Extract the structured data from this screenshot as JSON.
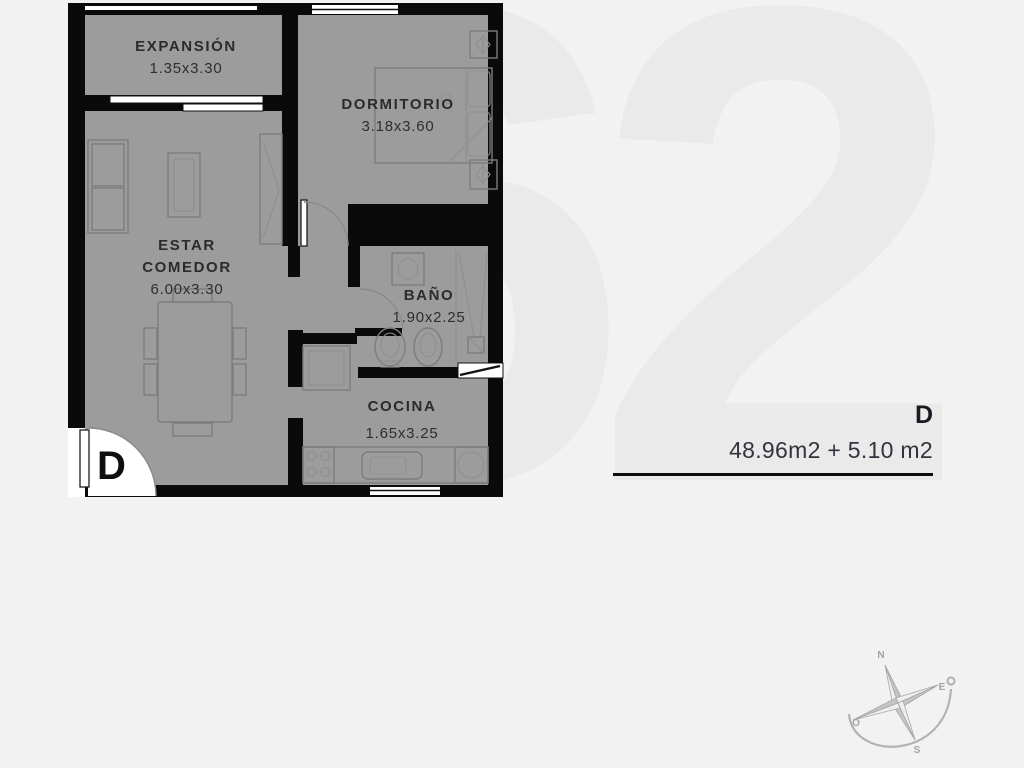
{
  "watermark": {
    "text": "62"
  },
  "floorplan": {
    "entry_label": "D",
    "rooms": [
      {
        "id": "expansion",
        "name": "EXPANSIÓN",
        "dims": "1.35x3.30"
      },
      {
        "id": "dormitorio",
        "name": "DORMITORIO",
        "dims": "3.18x3.60"
      },
      {
        "id": "estar-comedor",
        "name_line1": "ESTAR",
        "name_line2": "COMEDOR",
        "dims": "6.00x3.30"
      },
      {
        "id": "bano",
        "name": "BAÑO",
        "dims": "1.90x2.25"
      },
      {
        "id": "cocina",
        "name": "COCINA",
        "dims": "1.65x3.25"
      }
    ]
  },
  "annotation": {
    "unit_label": "D",
    "area_text": "48.96m2 + 5.10 m2"
  },
  "compass": {
    "north": "N",
    "east": "E",
    "south": "S",
    "west": "O"
  },
  "colors": {
    "bg": "#f2f2f2",
    "wall": "#0a0a0a",
    "floor": "#9c9c9c",
    "furniture": "#7d7d7d",
    "label": "#2b2b2b",
    "annotation_text": "#1a1a22",
    "area_text": "#33333d",
    "rule": "#0c0c0c",
    "compass": "#adadad",
    "watermark": "#eaeaea"
  }
}
